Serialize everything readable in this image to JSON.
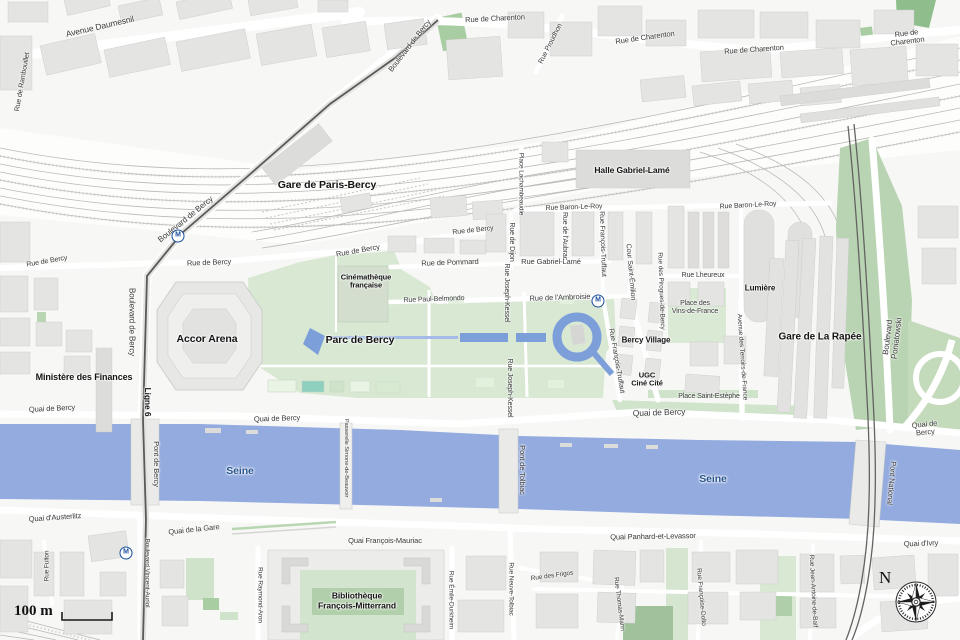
{
  "map": {
    "scale": {
      "label": "100 m"
    },
    "compass": {
      "label": "N"
    },
    "metro_letter": "M",
    "colors": {
      "water": "#93abdf",
      "water_dark": "#7d9fd9",
      "park_light": "#d8e8d3",
      "park_mid": "#cfe3ca",
      "park_dark": "#a9cda2",
      "green_big": "#b9d4b2",
      "green_corner": "#8fbe8c",
      "building": "#e4e4e2",
      "rail": "#b9b9b7",
      "seine_label": "#27568f",
      "metro_blue": "#1b4e9b",
      "street_label": "#3a3a3a"
    },
    "metro_stations": [
      {
        "x": 178,
        "y": 236
      },
      {
        "x": 598,
        "y": 301
      },
      {
        "x": 126,
        "y": 553
      }
    ],
    "labels": [
      {
        "t": "Avenue Daumesnil",
        "x": 100,
        "y": 27,
        "r": -13,
        "s": 8.5
      },
      {
        "t": "Rue de Rambouillet",
        "x": 23,
        "y": 82,
        "r": -80,
        "s": 7
      },
      {
        "t": "Boulevard de Bercy",
        "x": 410,
        "y": 46,
        "r": -52,
        "s": 7.5
      },
      {
        "t": "Rue de Charenton",
        "x": 495,
        "y": 19,
        "r": -3,
        "s": 7.5
      },
      {
        "t": "Rue Proudhon",
        "x": 551,
        "y": 44,
        "r": -63,
        "s": 7
      },
      {
        "t": "Rue de Charenton",
        "x": 645,
        "y": 38,
        "r": -8,
        "s": 7.5
      },
      {
        "t": "Rue de Charenton",
        "x": 754,
        "y": 50,
        "r": -4,
        "s": 7.5
      },
      {
        "t": "Rue de Charenton",
        "x": 907,
        "y": 38,
        "r": -7,
        "s": 7.5
      },
      {
        "t": "Gare de Paris-Bercy",
        "x": 327,
        "y": 186,
        "r": 0,
        "s": 10.5,
        "b": true
      },
      {
        "t": "Boulevard de Bercy",
        "x": 186,
        "y": 220,
        "r": -39,
        "s": 8
      },
      {
        "t": "Halle Gabriel-Lamé",
        "x": 632,
        "y": 171,
        "r": 0,
        "s": 8.5,
        "b": true
      },
      {
        "t": "Place Lachambeaudie",
        "x": 521,
        "y": 184,
        "r": 90,
        "s": 6.5
      },
      {
        "t": "Rue Baron-Le-Roy",
        "x": 574,
        "y": 208,
        "r": -2,
        "s": 7
      },
      {
        "t": "Rue Baron-Le-Roy",
        "x": 748,
        "y": 206,
        "r": -3,
        "s": 7
      },
      {
        "t": "Rue de Bercy",
        "x": 47,
        "y": 262,
        "r": -10,
        "s": 7
      },
      {
        "t": "Rue de Bercy",
        "x": 209,
        "y": 263,
        "r": -2,
        "s": 7.5
      },
      {
        "t": "Rue de Bercy",
        "x": 358,
        "y": 251,
        "r": -10,
        "s": 7.5
      },
      {
        "t": "Rue de Bercy",
        "x": 473,
        "y": 231,
        "r": -6,
        "s": 7
      },
      {
        "t": "Boulevard de Bercy",
        "x": 131,
        "y": 322,
        "r": 90,
        "s": 8
      },
      {
        "t": "Ligne 6",
        "x": 147,
        "y": 402,
        "r": 90,
        "s": 8.5,
        "b": true
      },
      {
        "t": "Cinémathèque\nfrançaise",
        "x": 366,
        "y": 282,
        "r": 0,
        "s": 7.5,
        "b": true
      },
      {
        "t": "Rue de Pommard",
        "x": 450,
        "y": 263,
        "r": -2,
        "s": 7.5
      },
      {
        "t": "Rue Gabriel-Lamé",
        "x": 551,
        "y": 262,
        "r": 0,
        "s": 7.5
      },
      {
        "t": "Rue Paul-Belmondo",
        "x": 434,
        "y": 300,
        "r": -2,
        "s": 7
      },
      {
        "t": "Rue de l'Ambroisie",
        "x": 560,
        "y": 298,
        "r": -2,
        "s": 7.5
      },
      {
        "t": "Rue de Dijon",
        "x": 511,
        "y": 242,
        "r": 90,
        "s": 7
      },
      {
        "t": "Rue de l'Aubrac",
        "x": 564,
        "y": 236,
        "r": 90,
        "s": 7
      },
      {
        "t": "Rue François-Truffaut",
        "x": 602,
        "y": 244,
        "r": 88,
        "s": 7
      },
      {
        "t": "Cour Saint-Émilion",
        "x": 630,
        "y": 272,
        "r": 85,
        "s": 7
      },
      {
        "t": "Rue Lheureux",
        "x": 703,
        "y": 276,
        "r": 0,
        "s": 7
      },
      {
        "t": "Rue des Pirogues-de-Bercy",
        "x": 661,
        "y": 291,
        "r": 88,
        "s": 6.5
      },
      {
        "t": "Place des\nVins-de-France",
        "x": 695,
        "y": 308,
        "r": 0,
        "s": 7
      },
      {
        "t": "Lumière",
        "x": 760,
        "y": 289,
        "r": 0,
        "s": 8,
        "b": true
      },
      {
        "t": "Accor Arena",
        "x": 207,
        "y": 340,
        "r": 0,
        "s": 10.5,
        "b": true
      },
      {
        "t": "Parc de Bercy",
        "x": 360,
        "y": 341,
        "r": 0,
        "s": 10.5,
        "b": true
      },
      {
        "t": "Rue Joseph-Kessel",
        "x": 506,
        "y": 293,
        "r": 90,
        "s": 7
      },
      {
        "t": "Rue Joseph-Kessel",
        "x": 509,
        "y": 388,
        "r": 90,
        "s": 7
      },
      {
        "t": "Rue François-Truffaut",
        "x": 616,
        "y": 361,
        "r": 80,
        "s": 7
      },
      {
        "t": "Bercy Village",
        "x": 646,
        "y": 341,
        "r": 0,
        "s": 8,
        "b": true
      },
      {
        "t": "UGC\nCiné Cité",
        "x": 647,
        "y": 380,
        "r": 0,
        "s": 7.5,
        "b": true
      },
      {
        "t": "Place Saint-Estèphe",
        "x": 709,
        "y": 397,
        "r": 0,
        "s": 7
      },
      {
        "t": "Avenue des Terroirs-de-France",
        "x": 742,
        "y": 357,
        "r": 86,
        "s": 6.5
      },
      {
        "t": "Gare de La Rapée",
        "x": 820,
        "y": 337,
        "r": 0,
        "s": 10,
        "b": true
      },
      {
        "t": "Boulevard Poniatowski",
        "x": 893,
        "y": 338,
        "r": -83,
        "s": 8
      },
      {
        "t": "Ministère des Finances",
        "x": 84,
        "y": 377,
        "r": 0,
        "s": 9,
        "b": true
      },
      {
        "t": "Quai de Bercy",
        "x": 52,
        "y": 409,
        "r": -3,
        "s": 7.5
      },
      {
        "t": "Quai de Bercy",
        "x": 277,
        "y": 419,
        "r": -2,
        "s": 7.5
      },
      {
        "t": "Quai de Bercy",
        "x": 659,
        "y": 413,
        "r": -2,
        "s": 8.5
      },
      {
        "t": "Quai de Bercy",
        "x": 925,
        "y": 429,
        "r": -6,
        "s": 7.5
      },
      {
        "t": "Pont de Bercy",
        "x": 156,
        "y": 464,
        "r": 90,
        "s": 7.5
      },
      {
        "t": "Passerelle Simone-de-Beauvoir",
        "x": 346,
        "y": 458,
        "r": 90,
        "s": 5.8
      },
      {
        "t": "Pont de Tolbiac",
        "x": 522,
        "y": 470,
        "r": 90,
        "s": 7.5
      },
      {
        "t": "Pont National",
        "x": 891,
        "y": 483,
        "r": 95,
        "s": 7.5
      },
      {
        "t": "Seine",
        "x": 240,
        "y": 472,
        "r": 0,
        "s": 10.5,
        "b": true,
        "c": "#27568f"
      },
      {
        "t": "Seine",
        "x": 713,
        "y": 480,
        "r": 0,
        "s": 10.5,
        "b": true,
        "c": "#27568f"
      },
      {
        "t": "Quai d'Austerlitz",
        "x": 55,
        "y": 518,
        "r": -4,
        "s": 7.5
      },
      {
        "t": "Quai de la Gare",
        "x": 194,
        "y": 530,
        "r": -6,
        "s": 7.5
      },
      {
        "t": "Quai François-Mauriac",
        "x": 385,
        "y": 541,
        "r": 0,
        "s": 7.5
      },
      {
        "t": "Quai Panhard-et-Levassor",
        "x": 653,
        "y": 537,
        "r": -1,
        "s": 7.5
      },
      {
        "t": "Quai d'Ivry",
        "x": 921,
        "y": 544,
        "r": -2,
        "s": 7.5
      },
      {
        "t": "Rue Fulton",
        "x": 47,
        "y": 566,
        "r": -90,
        "s": 6.5
      },
      {
        "t": "Boulevard Vincent-Auriol",
        "x": 147,
        "y": 573,
        "r": 90,
        "s": 6.5
      },
      {
        "t": "Rue Raymond-Aron",
        "x": 260,
        "y": 595,
        "r": 90,
        "s": 6.5
      },
      {
        "t": "Bibliothèque\nFrançois-Mitterrand",
        "x": 357,
        "y": 601,
        "r": 0,
        "s": 8.5,
        "b": true
      },
      {
        "t": "Rue Émile-Durkheim",
        "x": 451,
        "y": 600,
        "r": 90,
        "s": 6.5
      },
      {
        "t": "Rue Neuve-Tolbiac",
        "x": 511,
        "y": 589,
        "r": 90,
        "s": 6.5
      },
      {
        "t": "Rue des Frigos",
        "x": 552,
        "y": 576,
        "r": -8,
        "s": 6.5
      },
      {
        "t": "Rue Thomas-Mann",
        "x": 619,
        "y": 604,
        "r": 83,
        "s": 6.5
      },
      {
        "t": "Rue Françoise-Dolto",
        "x": 701,
        "y": 597,
        "r": 85,
        "s": 6.5
      },
      {
        "t": "Rue Jean-Antoine-de-Baïf",
        "x": 813,
        "y": 591,
        "r": 87,
        "s": 6.5
      }
    ]
  }
}
